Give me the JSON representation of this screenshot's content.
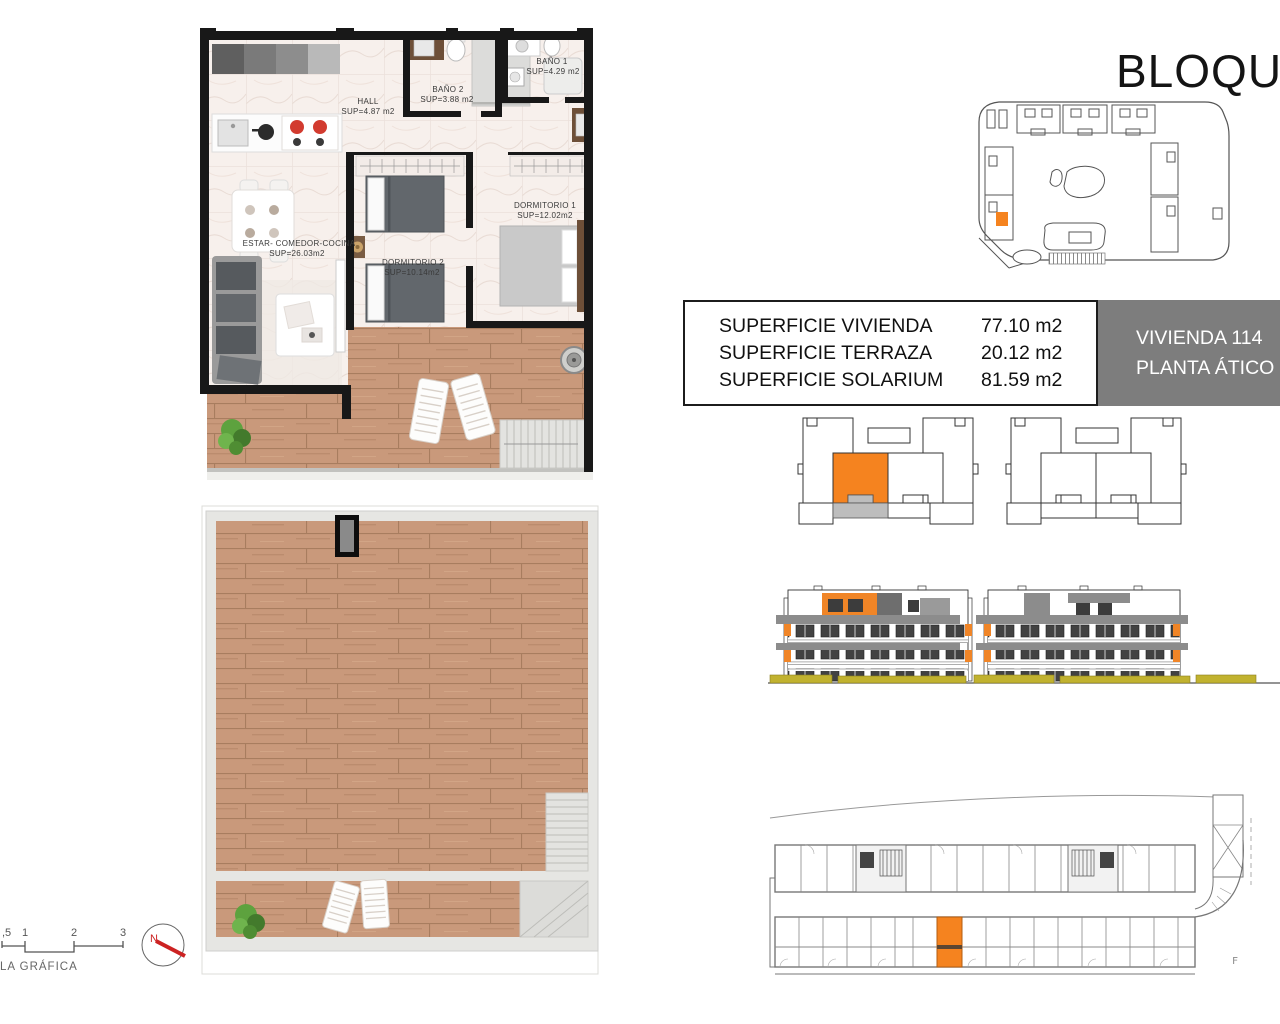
{
  "title": "BLOQUE",
  "info_box": {
    "line1": "VIVIENDA 114",
    "line2": "PLANTA ÁTICO"
  },
  "area_table": {
    "rows": [
      {
        "label": "SUPERFICIE VIVIENDA",
        "value": "77.10 m2"
      },
      {
        "label": "SUPERFICIE TERRAZA",
        "value": "20.12 m2"
      },
      {
        "label": "SUPERFICIE SOLARIUM",
        "value": "81.59 m2"
      }
    ]
  },
  "floor_plan": {
    "rooms": {
      "hall": {
        "name": "HALL",
        "sup": "SUP=4.87 m2"
      },
      "bano2": {
        "name": "BAÑO 2",
        "sup": "SUP=3.88 m2"
      },
      "bano1": {
        "name": "BAÑO 1",
        "sup": "SUP=4.29 m2"
      },
      "dormitorio1": {
        "name": "DORMITORIO 1",
        "sup": "SUP=12.02m2"
      },
      "dormitorio2": {
        "name": "DORMITORIO 2",
        "sup": "SUP=10.14m2"
      },
      "estar": {
        "name": "ESTAR- COMEDOR-COCINA",
        "sup": "SUP=26.03m2"
      }
    }
  },
  "scale_bar": {
    "ticks": {
      "t05": ",5",
      "t1": "1",
      "t2": "2",
      "t3": "3"
    },
    "label": "LA GRÁFICA"
  },
  "compass": {
    "north": "N"
  },
  "corner_mark": "F",
  "colors": {
    "accent_orange": "#f5831f",
    "terrace_gray": "#bdbdbd",
    "info_box_gray": "#7d7d7d",
    "hedge_yellow": "#c1b22f",
    "wood_brown": "#c9997b",
    "marble_pink": "#f7f0ec",
    "compass_red": "#cc2222"
  }
}
